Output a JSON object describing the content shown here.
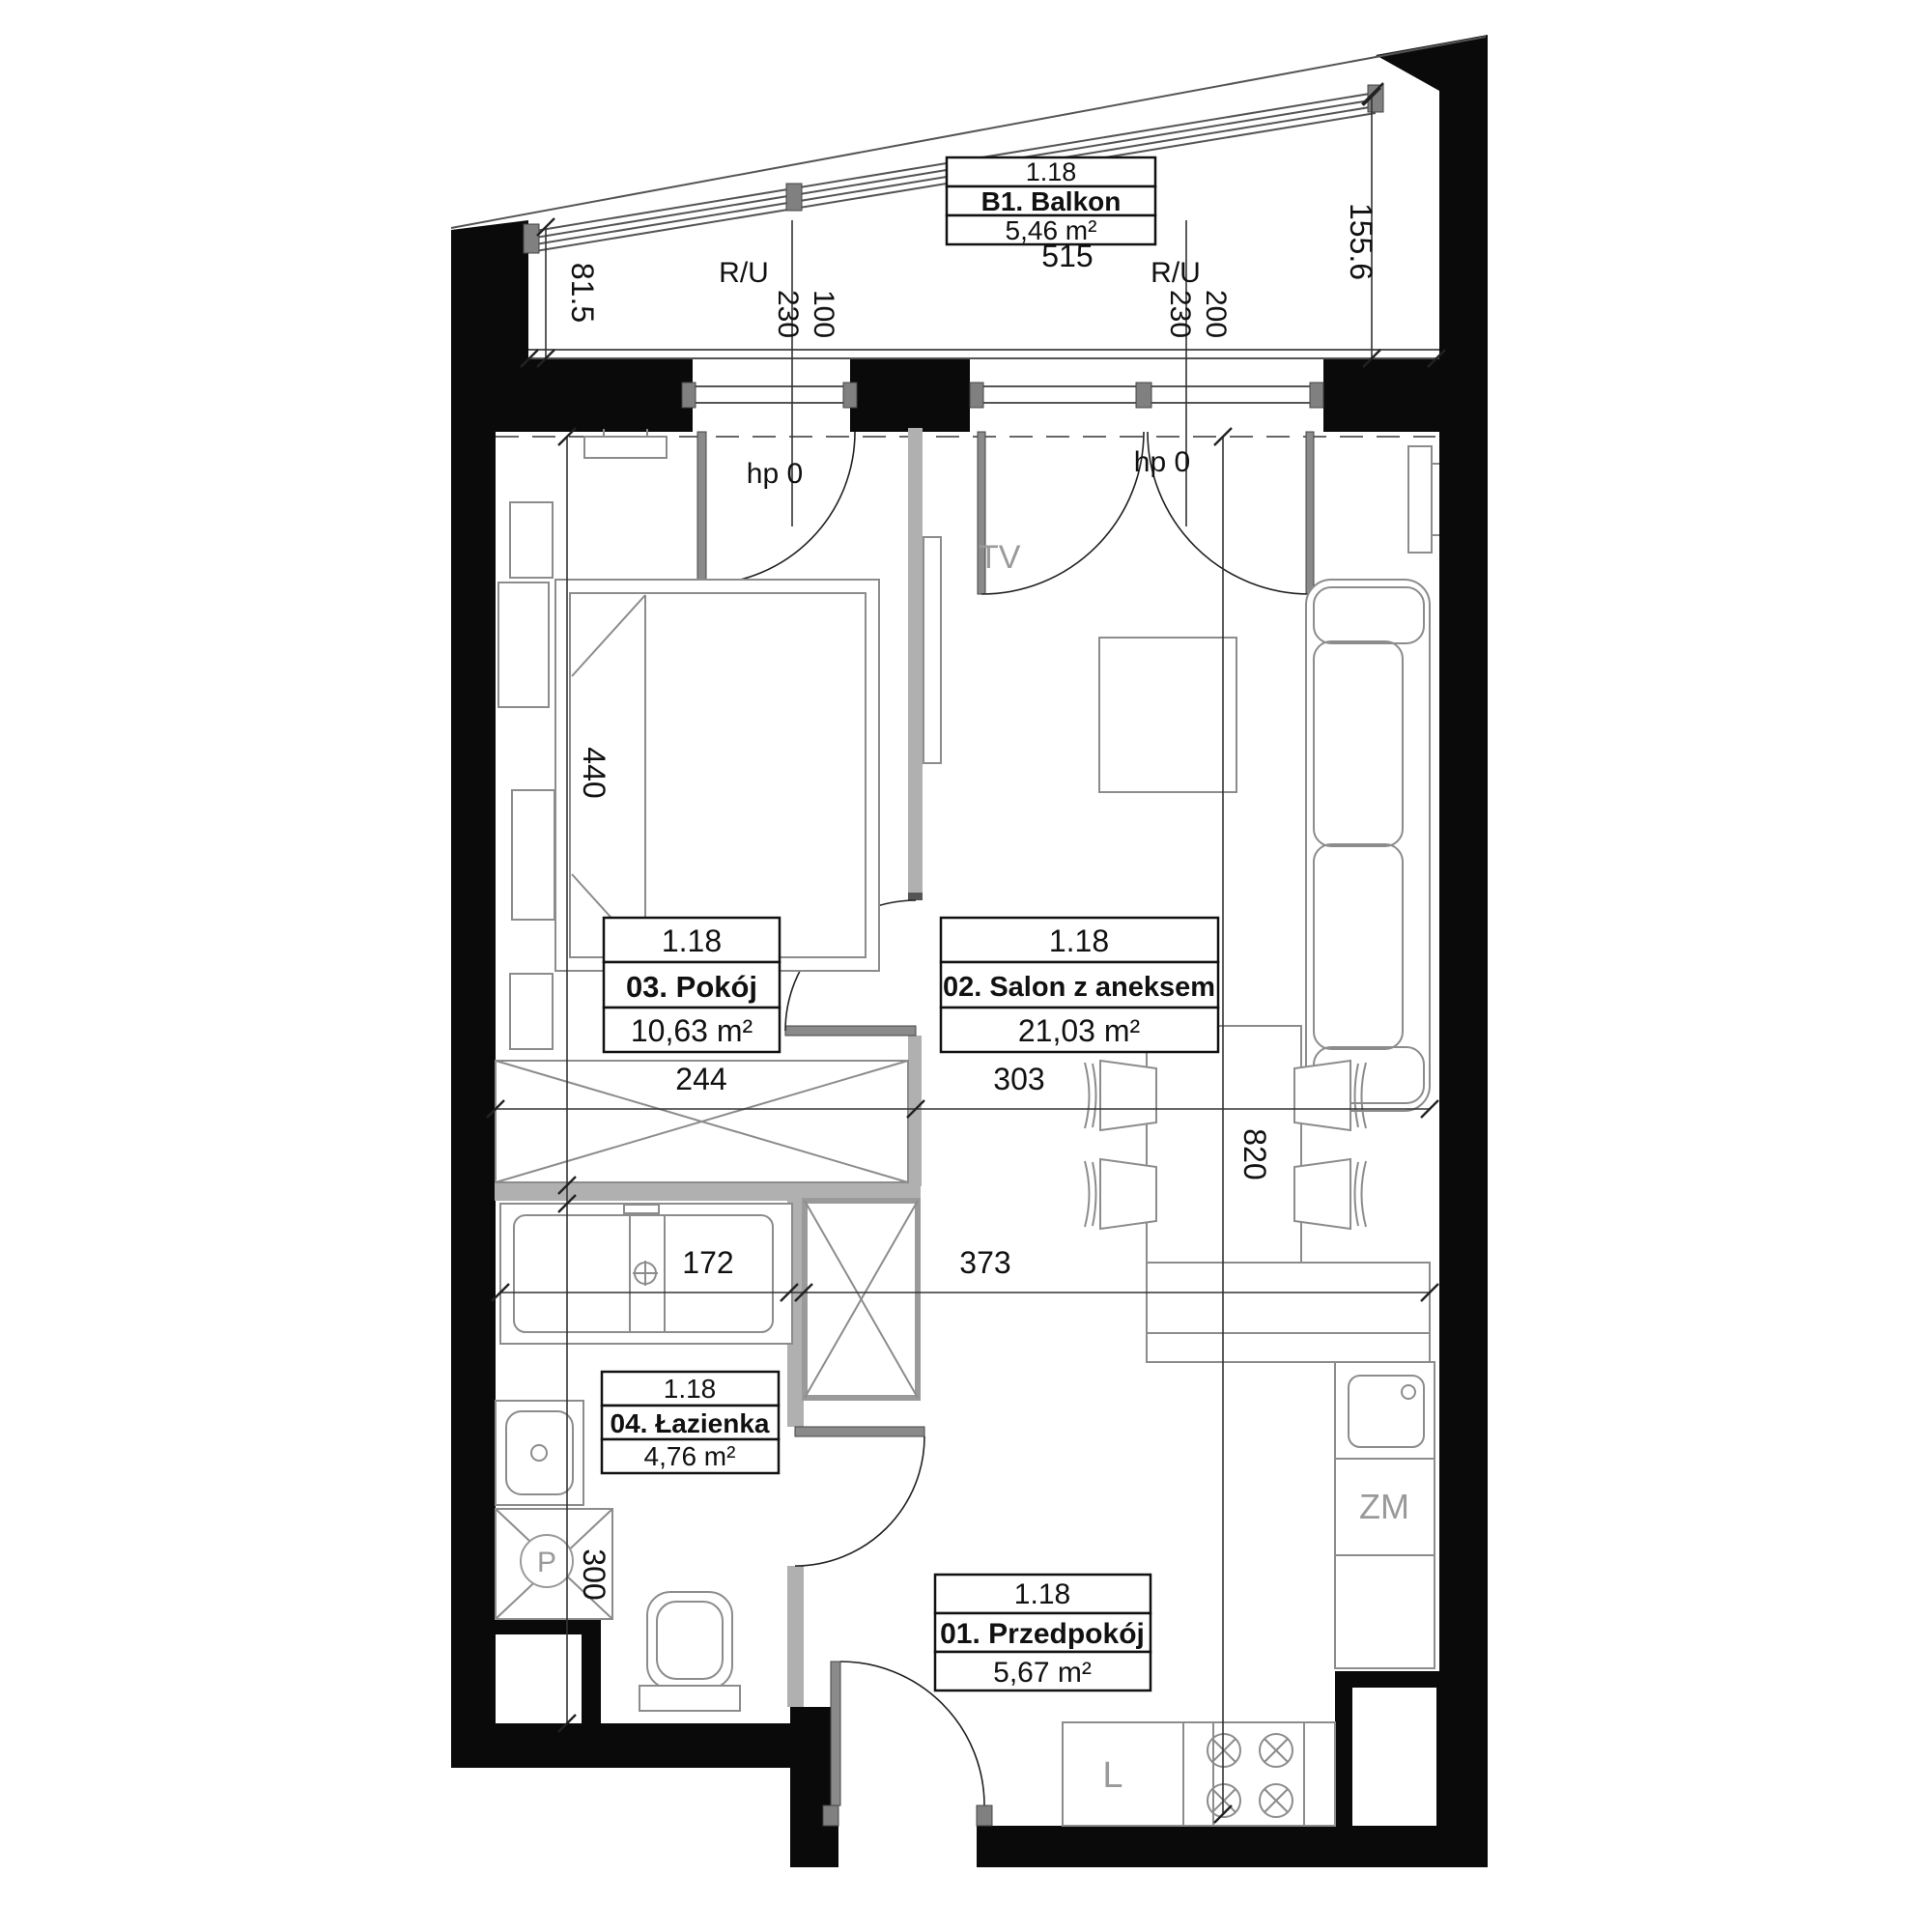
{
  "unit_code": "1.18",
  "rooms": [
    {
      "code": "1.18",
      "name": "B1. Balkon",
      "area": "5,46 m²"
    },
    {
      "code": "1.18",
      "name": "01. Przedpokój",
      "area": "5,67 m²"
    },
    {
      "code": "1.18",
      "name": "02. Salon z aneksem",
      "area": "21,03 m²"
    },
    {
      "code": "1.18",
      "name": "03. Pokój",
      "area": "10,63 m²"
    },
    {
      "code": "1.18",
      "name": "04. Łazienka",
      "area": "4,76 m²"
    }
  ],
  "dims": {
    "balcony_width": "515",
    "balcony_left_depth": "81.5",
    "balcony_right_depth": "155.6",
    "pokoj_width": "244",
    "salon_width": "303",
    "hall_width": "373",
    "bathtub": "172",
    "bath_wall": "300",
    "pokoj_depth": "440",
    "salon_depth": "820"
  },
  "windows": {
    "ru": "R/U",
    "left_h": "230",
    "left_w": "100",
    "right_h": "230",
    "right_w": "200",
    "hp": "hp 0"
  },
  "appliances": {
    "tv": "TV",
    "dishwasher": "ZM",
    "fridge": "L",
    "washer": "P"
  },
  "colors": {
    "wall": "#0a0a0a",
    "partition": "#b0b0b0",
    "annotation": "#9a9a9a"
  }
}
